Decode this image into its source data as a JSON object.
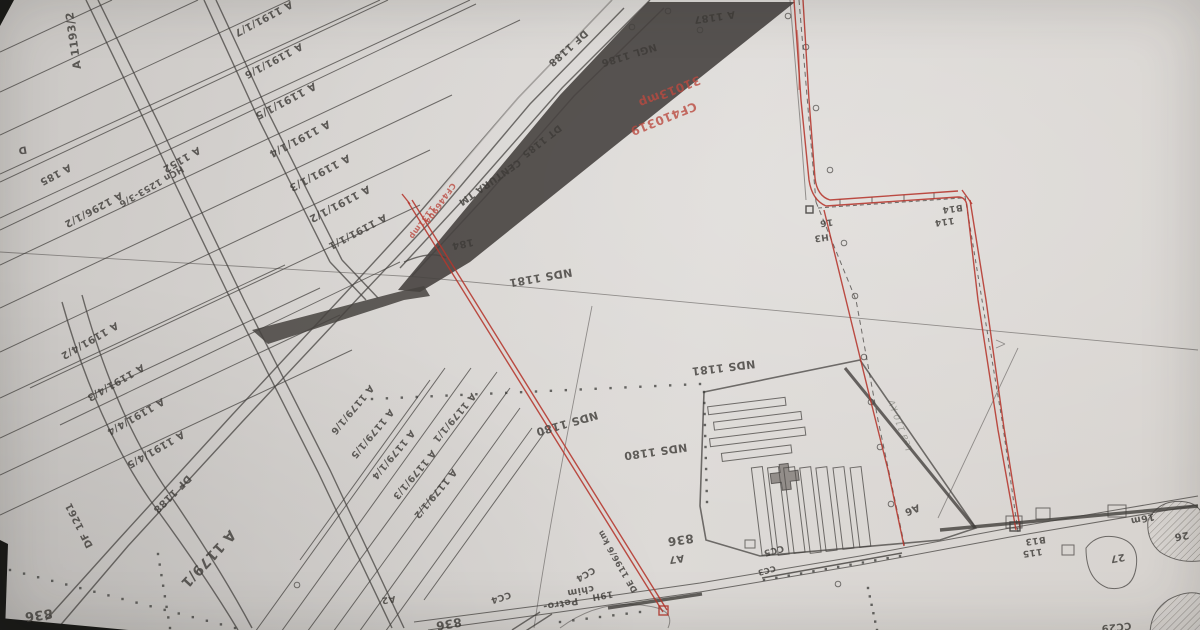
{
  "map": {
    "colors": {
      "paper": "#d7d4d1",
      "ink": "#3e3b38",
      "red_boundary": "#b5362c",
      "red_label": "#bb4a40",
      "corridor_shade": "#474340",
      "photo_edge": "#181816"
    },
    "labels": [
      {
        "text": "A 1193/2",
        "x": 77,
        "y": 40,
        "rot": 262,
        "size": 11
      },
      {
        "text": "A 1191/1/7",
        "x": 262,
        "y": 16,
        "rot": 152,
        "size": 10
      },
      {
        "text": "A 1191/1/6",
        "x": 272,
        "y": 58,
        "rot": 152,
        "size": 10
      },
      {
        "text": "A 1191/1/5",
        "x": 284,
        "y": 98,
        "rot": 152,
        "size": 10.5
      },
      {
        "text": "A 1191/1/4",
        "x": 298,
        "y": 136,
        "rot": 152,
        "size": 10.5
      },
      {
        "text": "A 1191/1/3",
        "x": 318,
        "y": 170,
        "rot": 152,
        "size": 10.5
      },
      {
        "text": "A 1191/1/2",
        "x": 338,
        "y": 201,
        "rot": 152,
        "size": 10.5
      },
      {
        "text": "A 1191/1/1",
        "x": 356,
        "y": 229,
        "rot": 152,
        "size": 10
      },
      {
        "text": "A 1296/1/2",
        "x": 92,
        "y": 207,
        "rot": 152,
        "size": 10
      },
      {
        "text": "A 185",
        "x": 54,
        "y": 172,
        "rot": 152,
        "size": 10
      },
      {
        "text": "D",
        "x": 22,
        "y": 147,
        "rot": 170,
        "size": 10
      },
      {
        "text": "HCn 1253-3/6",
        "x": 150,
        "y": 184,
        "rot": 150,
        "size": 9
      },
      {
        "text": "A 1152",
        "x": 180,
        "y": 157,
        "rot": 150,
        "size": 10
      },
      {
        "text": "A 1191/4/2",
        "x": 88,
        "y": 338,
        "rot": 150,
        "size": 10
      },
      {
        "text": "A 1191/4/3",
        "x": 114,
        "y": 380,
        "rot": 150,
        "size": 10
      },
      {
        "text": "A 1191/4/4",
        "x": 134,
        "y": 414,
        "rot": 150,
        "size": 10
      },
      {
        "text": "A 1191/4/5",
        "x": 154,
        "y": 447,
        "rot": 150,
        "size": 10
      },
      {
        "text": "DF 1261",
        "x": 82,
        "y": 524,
        "rot": 243,
        "size": 10
      },
      {
        "text": "DF 1188",
        "x": 566,
        "y": 46,
        "rot": 138,
        "size": 10
      },
      {
        "text": "DF 1188",
        "x": 170,
        "y": 492,
        "rot": 135,
        "size": 10
      },
      {
        "text": "NGL 1186",
        "x": 628,
        "y": 52,
        "rot": 163,
        "size": 10
      },
      {
        "text": "A 1187",
        "x": 714,
        "y": 14,
        "rot": 172,
        "size": 10
      },
      {
        "text": "DT 1185",
        "x": 540,
        "y": 139,
        "rot": 142,
        "size": 9.5
      },
      {
        "text": "CENTURA TM",
        "x": 488,
        "y": 180,
        "rot": 145,
        "size": 9.5
      },
      {
        "text": "184",
        "x": 462,
        "y": 241,
        "rot": 168,
        "size": 10
      },
      {
        "text": "31013mp",
        "x": 668,
        "y": 88,
        "rot": 158,
        "size": 12,
        "color": "red"
      },
      {
        "text": "CF410319",
        "x": 662,
        "y": 115,
        "rot": 158,
        "size": 12,
        "color": "red"
      },
      {
        "text": "CF446904",
        "x": 438,
        "y": 202,
        "rot": 125,
        "size": 8,
        "color": "red"
      },
      {
        "text": "1131mp",
        "x": 420,
        "y": 221,
        "rot": 125,
        "size": 8,
        "color": "red"
      },
      {
        "text": "NDS 1181",
        "x": 540,
        "y": 274,
        "rot": 170,
        "size": 11
      },
      {
        "text": "NDS 1181",
        "x": 723,
        "y": 364,
        "rot": 173,
        "size": 11
      },
      {
        "text": "NDS 1180",
        "x": 566,
        "y": 420,
        "rot": 164,
        "size": 11
      },
      {
        "text": "NDS 1180",
        "x": 655,
        "y": 448,
        "rot": 172,
        "size": 11
      },
      {
        "text": "A 1179/1",
        "x": 205,
        "y": 556,
        "rot": 133,
        "size": 14
      },
      {
        "text": "A 1179/1/1",
        "x": 452,
        "y": 416,
        "rot": 130,
        "size": 9.5
      },
      {
        "text": "A 1179/1/6",
        "x": 350,
        "y": 408,
        "rot": 130,
        "size": 9.5
      },
      {
        "text": "A 1179/1/5",
        "x": 370,
        "y": 432,
        "rot": 130,
        "size": 9.5
      },
      {
        "text": "A 1179/1/4",
        "x": 391,
        "y": 453,
        "rot": 130,
        "size": 9.5
      },
      {
        "text": "A 1179/1/3",
        "x": 412,
        "y": 473,
        "rot": 130,
        "size": 9.5
      },
      {
        "text": "A 1179/1/2",
        "x": 433,
        "y": 492,
        "rot": 130,
        "size": 9.5
      },
      {
        "text": "A2",
        "x": 388,
        "y": 597,
        "rot": 172,
        "size": 9
      },
      {
        "text": "836",
        "x": 38,
        "y": 611,
        "rot": 172,
        "size": 13
      },
      {
        "text": "836",
        "x": 448,
        "y": 620,
        "rot": 170,
        "size": 12
      },
      {
        "text": "836",
        "x": 680,
        "y": 536,
        "rot": 172,
        "size": 12
      },
      {
        "text": "A7",
        "x": 676,
        "y": 556,
        "rot": 172,
        "size": 10
      },
      {
        "text": "CC4",
        "x": 500,
        "y": 595,
        "rot": 162,
        "size": 9
      },
      {
        "text": "CC4",
        "x": 584,
        "y": 572,
        "rot": 150,
        "size": 9
      },
      {
        "text": "DE 1196/6 km",
        "x": 620,
        "y": 560,
        "rot": 240,
        "size": 8.5
      },
      {
        "text": "19H",
        "x": 602,
        "y": 593,
        "rot": 170,
        "size": 9
      },
      {
        "text": "Petro-",
        "x": 560,
        "y": 601,
        "rot": 170,
        "size": 9.5
      },
      {
        "text": "chim",
        "x": 580,
        "y": 588,
        "rot": 170,
        "size": 9.5
      },
      {
        "text": "CC5",
        "x": 773,
        "y": 548,
        "rot": 165,
        "size": 9
      },
      {
        "text": "CC3",
        "x": 766,
        "y": 568,
        "rot": 165,
        "size": 8
      },
      {
        "text": "A6",
        "x": 911,
        "y": 507,
        "rot": 158,
        "size": 10
      },
      {
        "text": "B13",
        "x": 1035,
        "y": 538,
        "rot": 172,
        "size": 9
      },
      {
        "text": "115",
        "x": 1032,
        "y": 550,
        "rot": 172,
        "size": 9
      },
      {
        "text": "16m",
        "x": 1142,
        "y": 516,
        "rot": 168,
        "size": 9.5
      },
      {
        "text": "27",
        "x": 1117,
        "y": 555,
        "rot": 170,
        "size": 10
      },
      {
        "text": "26",
        "x": 1181,
        "y": 533,
        "rot": 170,
        "size": 10
      },
      {
        "text": "CC29",
        "x": 1116,
        "y": 624,
        "rot": 174,
        "size": 10
      },
      {
        "text": "16",
        "x": 826,
        "y": 220,
        "rot": 172,
        "size": 9
      },
      {
        "text": "H3",
        "x": 821,
        "y": 235,
        "rot": 172,
        "size": 9
      },
      {
        "text": "B14",
        "x": 952,
        "y": 206,
        "rot": 172,
        "size": 9
      },
      {
        "text": "114",
        "x": 944,
        "y": 219,
        "rot": 172,
        "size": 9
      },
      {
        "text": "Lea 110 kV",
        "x": 903,
        "y": 424,
        "rot": 250,
        "size": 9,
        "color": "faint"
      }
    ]
  }
}
